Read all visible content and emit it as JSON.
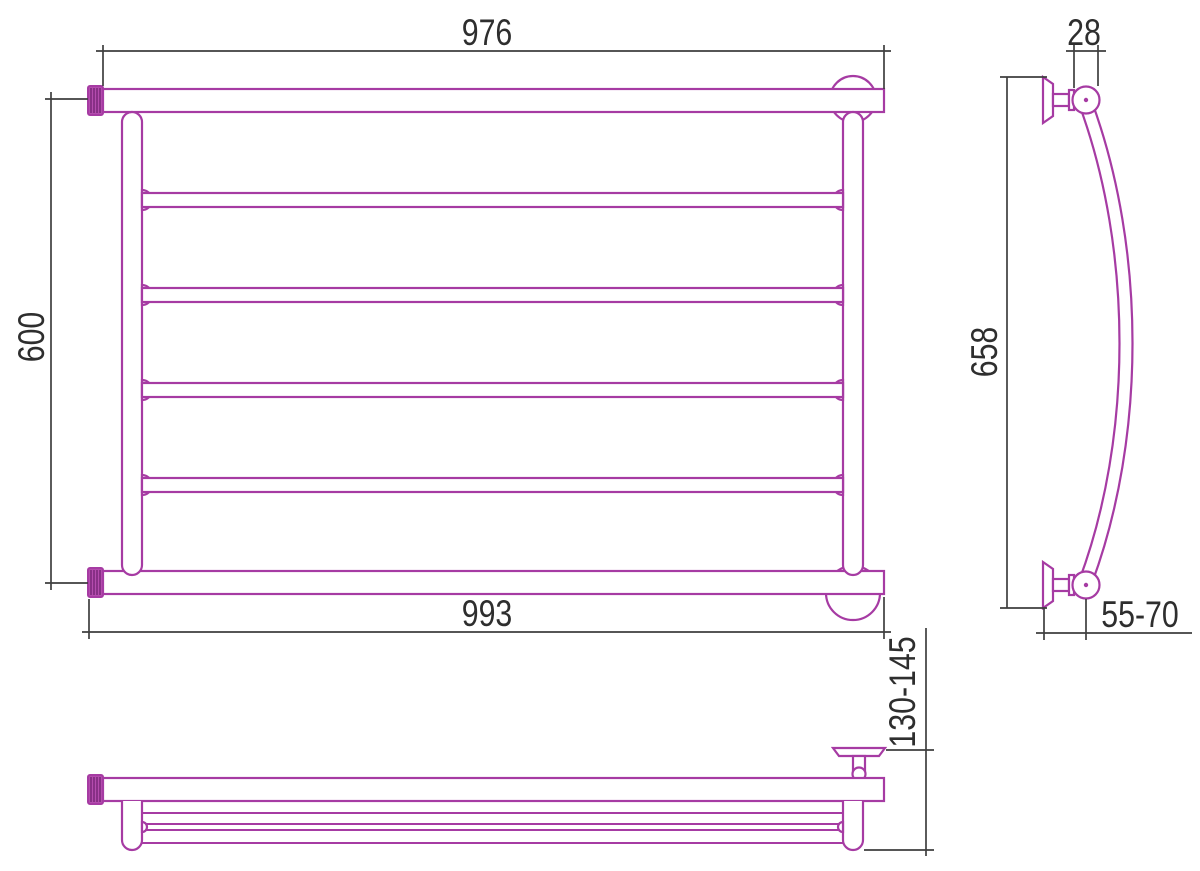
{
  "dimensions": {
    "front_width_top": "976",
    "front_height": "600",
    "front_width_bottom": "993",
    "side_tube_offset": "28",
    "side_height": "658",
    "side_wall_distance": "55-70",
    "plan_depth": "130-145"
  },
  "colors": {
    "product_line": "#a63ba3",
    "fitting_fill": "#b44cae",
    "fitting_hatch": "#7d2a7d",
    "dimension_line": "#3f3f3f",
    "background": "#ffffff"
  }
}
